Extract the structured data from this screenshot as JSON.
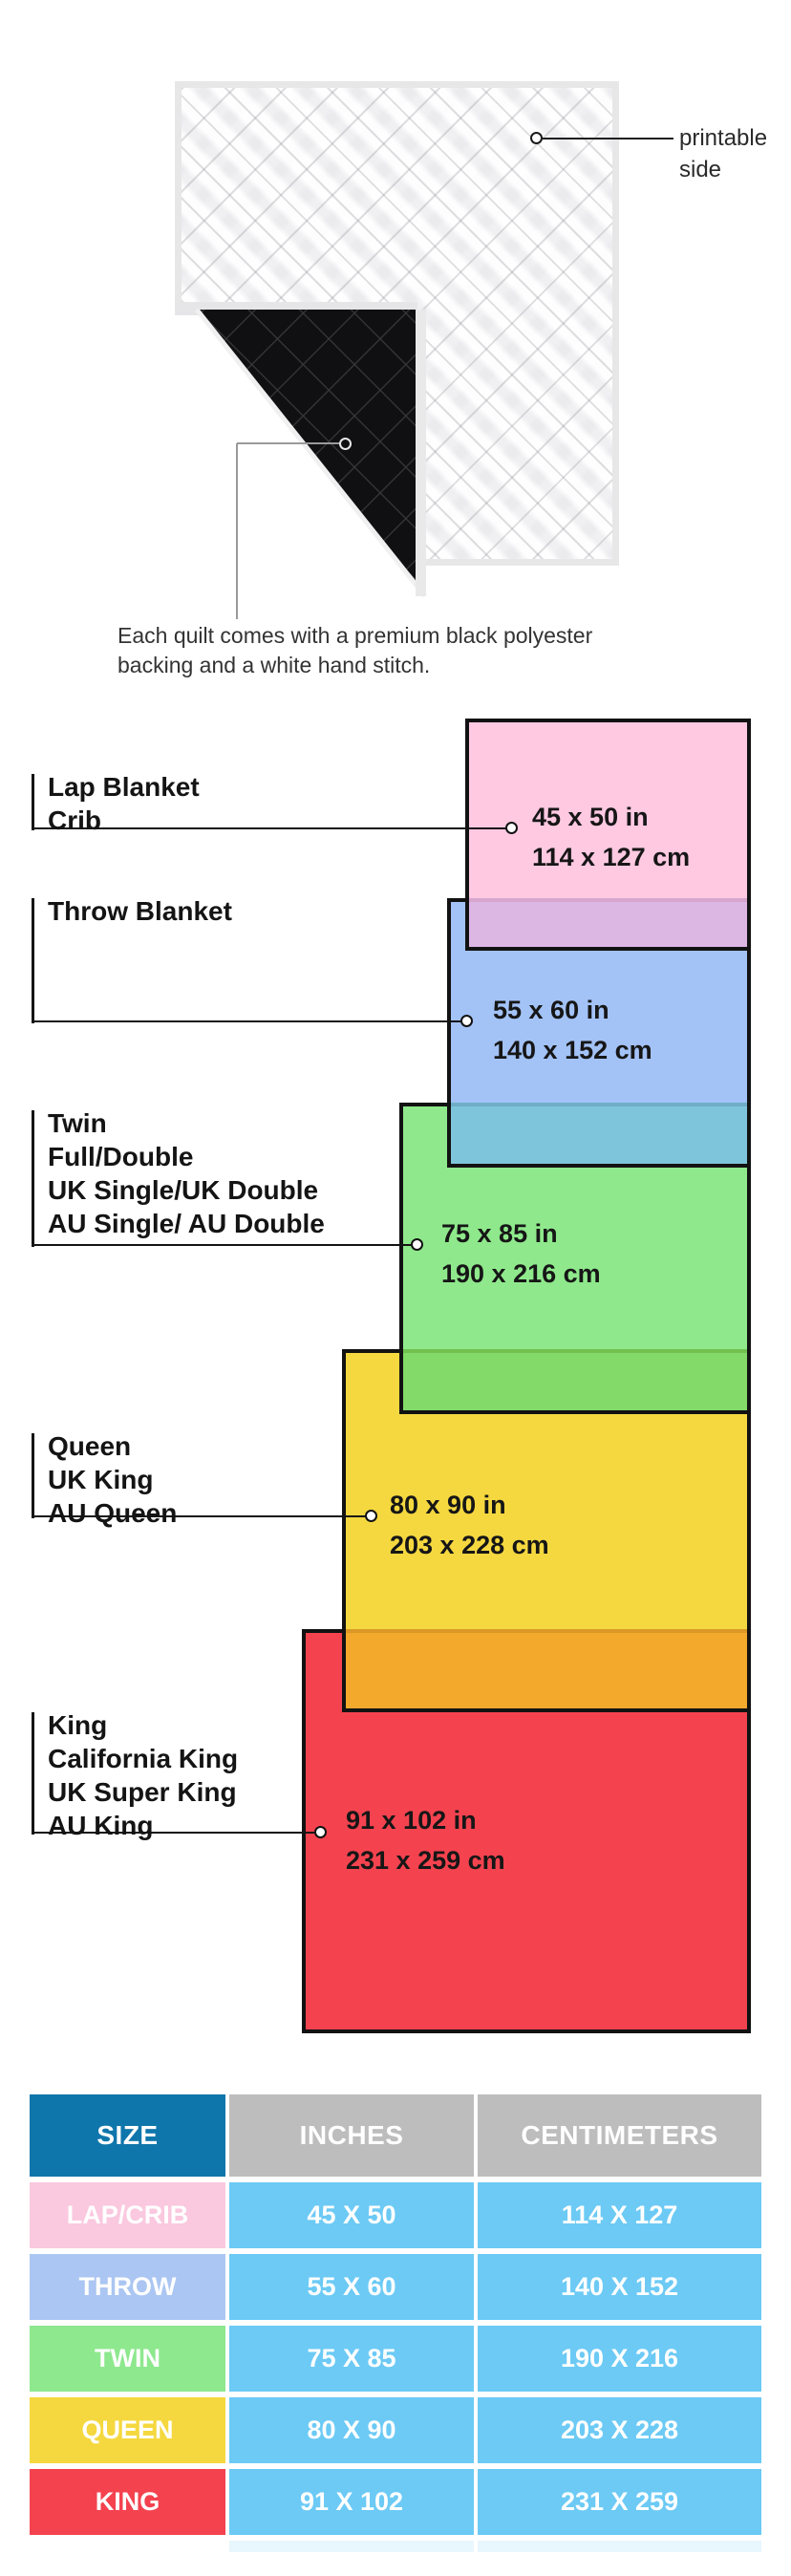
{
  "hero": {
    "printable_label": "printable side",
    "caption": "Each quilt comes with a premium black polyester\nbacking and a white hand stitch."
  },
  "diagram": {
    "sizes": [
      {
        "key": "lap",
        "labels": [
          "Lap Blanket",
          "Crib"
        ],
        "inches": "45 x 50 in",
        "centimeters": "114 x 127 cm",
        "fill": "#FFC9E2"
      },
      {
        "key": "throw",
        "labels": [
          "Throw Blanket"
        ],
        "inches": "55 x 60 in",
        "centimeters": "140 x 152 cm",
        "fill": "#A3C2F6"
      },
      {
        "key": "twin",
        "labels": [
          "Twin",
          "Full/Double",
          "UK Single/UK Double",
          "AU Single/ AU Double"
        ],
        "inches": "75 x 85 in",
        "centimeters": "190 x 216 cm",
        "fill": "#8FE98C"
      },
      {
        "key": "queen",
        "labels": [
          "Queen",
          "UK King",
          "AU Queen"
        ],
        "inches": "80 x 90 in",
        "centimeters": "203 x 228 cm",
        "fill": "#F5D840"
      },
      {
        "key": "king",
        "labels": [
          "King",
          "California King",
          "UK Super King",
          "AU King"
        ],
        "inches": "91 x 102 in",
        "centimeters": "231 x 259 cm",
        "fill": "#F4434F"
      }
    ]
  },
  "table": {
    "headers": [
      "SIZE",
      "INCHES",
      "CENTIMETERS"
    ],
    "rows": [
      {
        "size": "LAP/CRIB",
        "inches": "45 X 50",
        "centimeters": "114 X 127",
        "label_color": "#FAC8DF"
      },
      {
        "size": "THROW",
        "inches": "55 X 60",
        "centimeters": "140 X 152",
        "label_color": "#ABC6F2"
      },
      {
        "size": "TWIN",
        "inches": "75 X 85",
        "centimeters": "190 X 216",
        "label_color": "#8EE88E"
      },
      {
        "size": "QUEEN",
        "inches": "80 X 90",
        "centimeters": "203 X 228",
        "label_color": "#F5D83F"
      },
      {
        "size": "KING",
        "inches": "91 X 102",
        "centimeters": "231 X 259",
        "label_color": "#F4424F"
      }
    ],
    "colors": {
      "size_header": "#0F76AB",
      "unit_header": "#BDBDBD",
      "value_cell": "#6CCAF5"
    }
  }
}
